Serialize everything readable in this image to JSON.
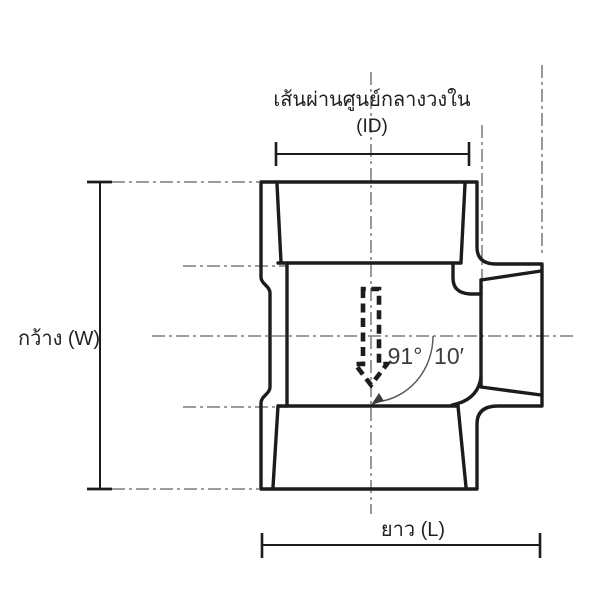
{
  "labels": {
    "inner_diameter_title": "เส้นผ่านศูนย์กลางวงใน",
    "inner_diameter_symbol": "(ID)",
    "width": "กว้าง (W)",
    "length": "ยาว (L)"
  },
  "annotations": {
    "angle_degrees": "91°",
    "angle_minutes": "10′"
  },
  "colors": {
    "ink": "#1c1c1c",
    "centerline": "#8f8f8f",
    "dimension": "#1c1c1c",
    "annotation": "#3c3c3c"
  }
}
